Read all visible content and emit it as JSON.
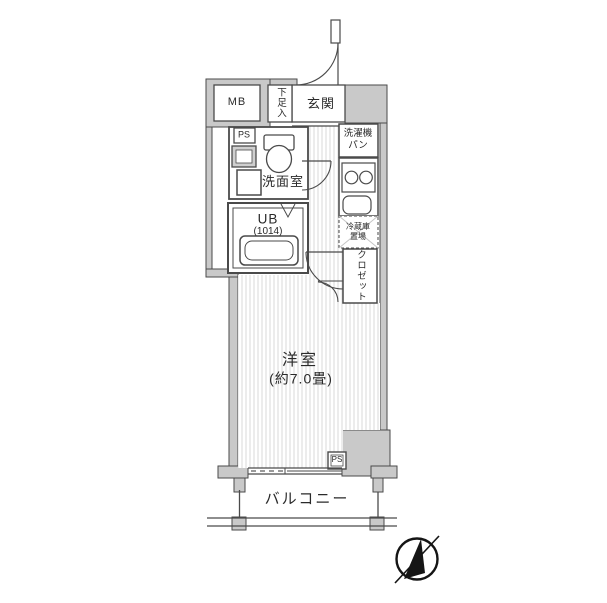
{
  "floorplan": {
    "meterbox_label": "MB",
    "shoe_cabinet_label": "下足入",
    "entrance_label": "玄関",
    "pipe_space_upper_label": "PS",
    "washroom_label": "洗面室",
    "washer_pan_label": "洗濯機\nパン",
    "unit_bath_label": "UB",
    "unit_bath_size_label": "(1014)",
    "fridge_space_label": "冷蔵庫\n置場",
    "closet_label": "クロゼット",
    "main_room_label": "洋室",
    "main_room_size_label": "(約7.0畳)",
    "pipe_space_lower_label": "PS",
    "balcony_label": "バルコニー",
    "colors": {
      "wall_fill": "#c9c9c9",
      "outline": "#4a4a4a",
      "floor_hatch": "#dadada",
      "compass": "#151515"
    }
  }
}
